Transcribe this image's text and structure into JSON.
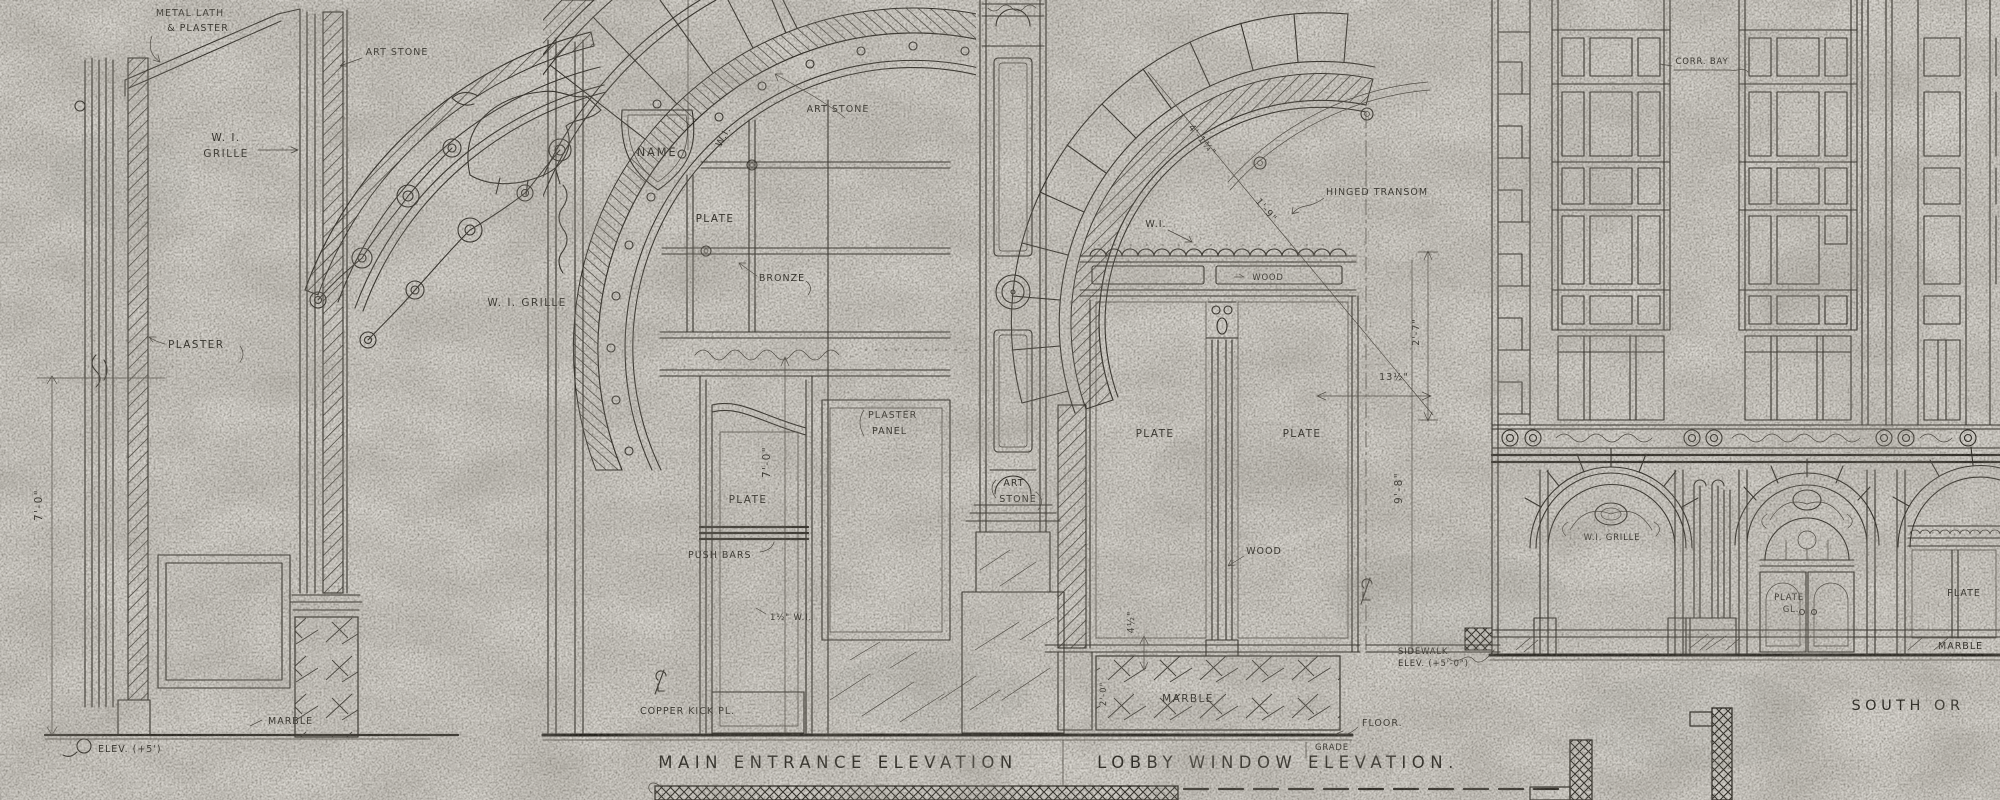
{
  "colors": {
    "paper": "#d9d6d0",
    "ink": "#26231d",
    "ink_faint": "#55514a"
  },
  "titles": {
    "main_entrance": "MAIN ENTRANCE ELEVATION",
    "lobby_window": "LOBBY WINDOW ELEVATION.",
    "south_partial": "SOUTH OR"
  },
  "jamb_detail": {
    "metal_lath1": "METAL LATH",
    "metal_lath2": "& PLASTER",
    "art_stone": "ART STONE",
    "wi1": "W. I.",
    "wi2": "GRILLE",
    "plaster": "PLASTER",
    "marble": "MARBLE",
    "elev": "ELEV. (+5')",
    "dim7": "7'-0\""
  },
  "grille_detail": {
    "name": "NAME",
    "wi_grille": "W. I. GRILLE"
  },
  "entrance": {
    "art_stone": "ART STONE",
    "wi": "W.I.",
    "plate": "PLATE",
    "bronze": "BRONZE",
    "plaster_panel1": "PLASTER",
    "plaster_panel2": "PANEL",
    "art1": "ART",
    "art2": "STONE",
    "plate_door": "PLATE",
    "dim7": "7'-0\"",
    "push_bars": "PUSH BARS",
    "wi_bar": "1½\" W.I.",
    "copper": "COPPER KICK PL."
  },
  "lobby": {
    "hinged": "HINGED TRANSOM",
    "wi": "W.I.",
    "wood1": "WOOD",
    "wood2": "WOOD",
    "plate_l": "PLATE",
    "plate_r": "PLATE",
    "marble": "MARBLE",
    "floor": "FLOOR.",
    "grade": "GRADE",
    "sidewalk1": "SIDEWALK",
    "sidewalk2": "ELEV. (+5'-0\")",
    "d1": "4'-1¾\"",
    "d2": "1'-9\"",
    "d3": "2'-7\"",
    "d4": "13½\"",
    "d5": "4½\"",
    "d6": "9'-8\"",
    "d7": "2'-0\""
  },
  "facade": {
    "corr_bay": "CORR. BAY",
    "wi_grille": "W.I. GRILLE",
    "plate_gl1": "PLATE",
    "plate_gl2": "GL.",
    "plate": "PLATE",
    "marble": "MARBLE"
  }
}
